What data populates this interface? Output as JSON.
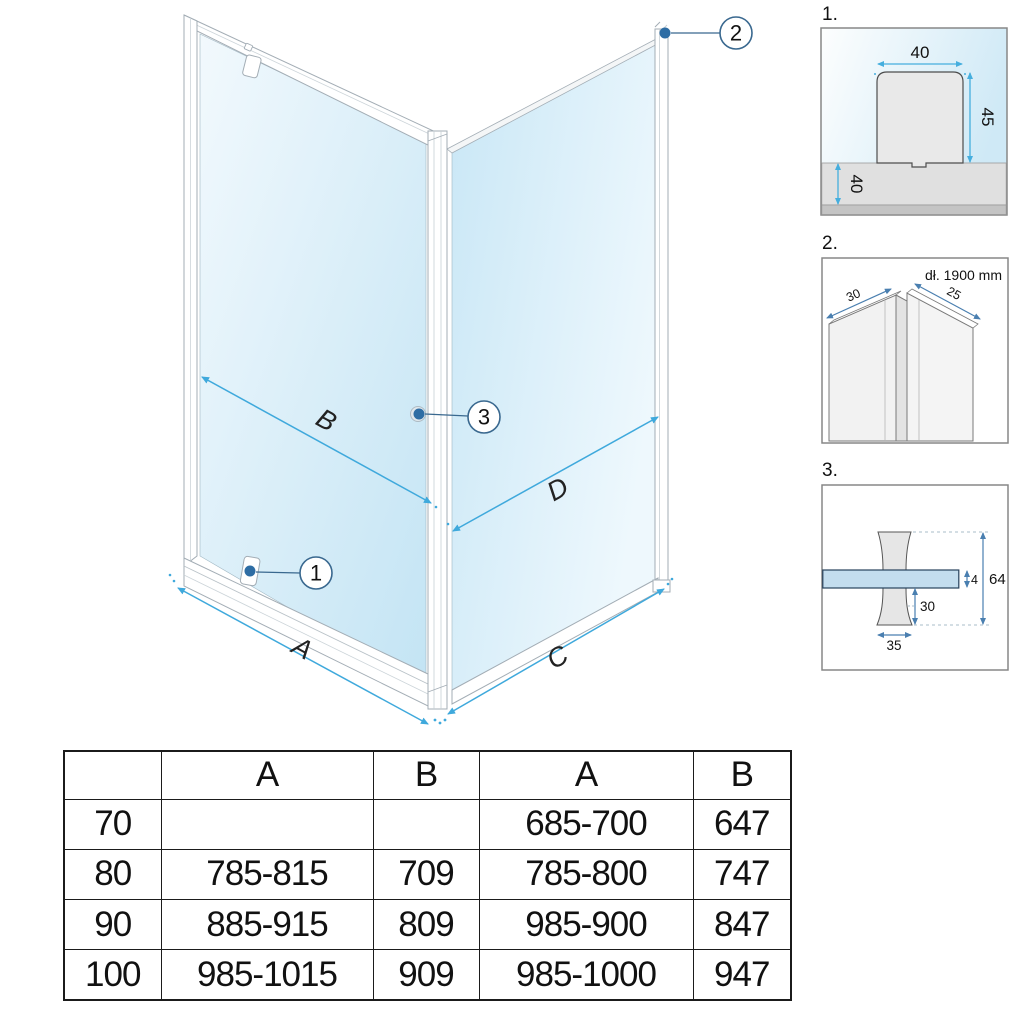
{
  "main": {
    "dim_a": "A",
    "dim_b": "B",
    "dim_c": "C",
    "dim_d": "D",
    "callout_1": "1",
    "callout_2": "2",
    "callout_3": "3"
  },
  "details": [
    {
      "label": "1.",
      "dim_top": "40",
      "dim_right": "45",
      "dim_wall": "40"
    },
    {
      "label": "2.",
      "note": "dł. 1900 mm",
      "dim_left": "30",
      "dim_right": "25"
    },
    {
      "label": "3.",
      "dim_glass": "4",
      "dim_total": "64",
      "dim_knob": "30",
      "dim_width": "35"
    }
  ],
  "table": {
    "header": [
      "",
      "A",
      "B",
      "A",
      "B"
    ],
    "rows": [
      [
        "70",
        "",
        "",
        "685-700",
        "647"
      ],
      [
        "80",
        "785-815",
        "709",
        "785-800",
        "747"
      ],
      [
        "90",
        "885-915",
        "809",
        "985-900",
        "847"
      ],
      [
        "100",
        "985-1015",
        "909",
        "985-1000",
        "947"
      ]
    ]
  },
  "colors": {
    "accent_arrow_blue": "#3fa9dc",
    "detail_arrow_blue": "#4a7fb0",
    "callout_stroke_blue": "#39688f",
    "dot_blue": "#2e6da4",
    "glass_blue": "#c6e5f4",
    "frame_gray": "#a3adb5",
    "table_border": "#1b1b1b"
  }
}
